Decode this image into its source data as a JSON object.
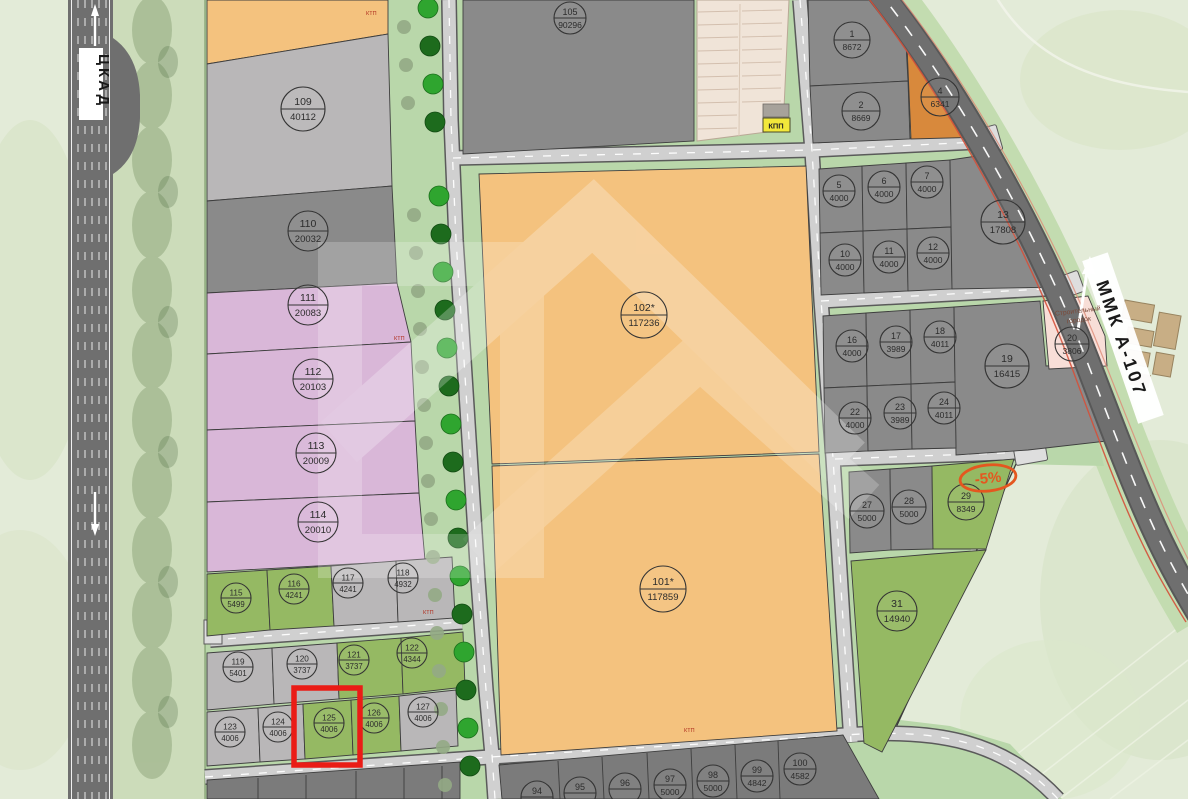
{
  "roads": {
    "left": "ЦКАД",
    "right": "ММК А-107"
  },
  "markers": {
    "checkpoint": "КПП",
    "camp_line1": "Строительный",
    "camp_line2": "городок",
    "discount": "-5%",
    "substation": "КТП"
  },
  "highlight_color": "#ea1c16",
  "palette": {
    "gray_dark": "#8a8a8a",
    "gray_light": "#b9b7b8",
    "gray_bottom": "#7b7b7b",
    "pink": "#d9b7d8",
    "green": "#95b963",
    "orange": "#f4c27e",
    "orange_dark": "#d8893c",
    "pink_light": "#f8ded7"
  },
  "plots": {
    "p1": {
      "number": "1",
      "area": "8672"
    },
    "p2": {
      "number": "2",
      "area": "8669"
    },
    "p4": {
      "number": "4",
      "area": "6341"
    },
    "p5": {
      "number": "5",
      "area": "4000"
    },
    "p6": {
      "number": "6",
      "area": "4000"
    },
    "p7": {
      "number": "7",
      "area": "4000"
    },
    "p10": {
      "number": "10",
      "area": "4000"
    },
    "p11": {
      "number": "11",
      "area": "4000"
    },
    "p12": {
      "number": "12",
      "area": "4000"
    },
    "p13": {
      "number": "13",
      "area": "17808"
    },
    "p16": {
      "number": "16",
      "area": "4000"
    },
    "p17": {
      "number": "17",
      "area": "3989"
    },
    "p18": {
      "number": "18",
      "area": "4011"
    },
    "p19": {
      "number": "19",
      "area": "16415"
    },
    "p20": {
      "number": "20",
      "area": "3806"
    },
    "p22": {
      "number": "22",
      "area": "4000"
    },
    "p23": {
      "number": "23",
      "area": "3989"
    },
    "p24": {
      "number": "24",
      "area": "4011"
    },
    "p27": {
      "number": "27",
      "area": "5000"
    },
    "p28": {
      "number": "28",
      "area": "5000"
    },
    "p29": {
      "number": "29",
      "area": "8349"
    },
    "p31": {
      "number": "31",
      "area": "14940"
    },
    "p94": {
      "number": "94",
      "area": ""
    },
    "p95": {
      "number": "95",
      "area": ""
    },
    "p96": {
      "number": "96",
      "area": ""
    },
    "p97": {
      "number": "97",
      "area": "5000"
    },
    "p98": {
      "number": "98",
      "area": "5000"
    },
    "p99": {
      "number": "99",
      "area": "4842"
    },
    "p100": {
      "number": "100",
      "area": "4582"
    },
    "p101": {
      "number": "101*",
      "area": "117859"
    },
    "p102": {
      "number": "102*",
      "area": "117236"
    },
    "p105": {
      "number": "105",
      "area": "90296"
    },
    "p109": {
      "number": "109",
      "area": "40112"
    },
    "p110": {
      "number": "110",
      "area": "20032"
    },
    "p111": {
      "number": "111",
      "area": "20083"
    },
    "p112": {
      "number": "112",
      "area": "20103"
    },
    "p113": {
      "number": "113",
      "area": "20009"
    },
    "p114": {
      "number": "114",
      "area": "20010"
    },
    "p115": {
      "number": "115",
      "area": "5499"
    },
    "p116": {
      "number": "116",
      "area": "4241"
    },
    "p117": {
      "number": "117",
      "area": "4241"
    },
    "p118": {
      "number": "118",
      "area": "4932"
    },
    "p119": {
      "number": "119",
      "area": "5401"
    },
    "p120": {
      "number": "120",
      "area": "3737"
    },
    "p121": {
      "number": "121",
      "area": "3737"
    },
    "p122": {
      "number": "122",
      "area": "4344"
    },
    "p123": {
      "number": "123",
      "area": "4006"
    },
    "p124": {
      "number": "124",
      "area": "4006"
    },
    "p125": {
      "number": "125",
      "area": "4006"
    },
    "p126": {
      "number": "126",
      "area": "4006"
    },
    "p127": {
      "number": "127",
      "area": "4006"
    }
  }
}
